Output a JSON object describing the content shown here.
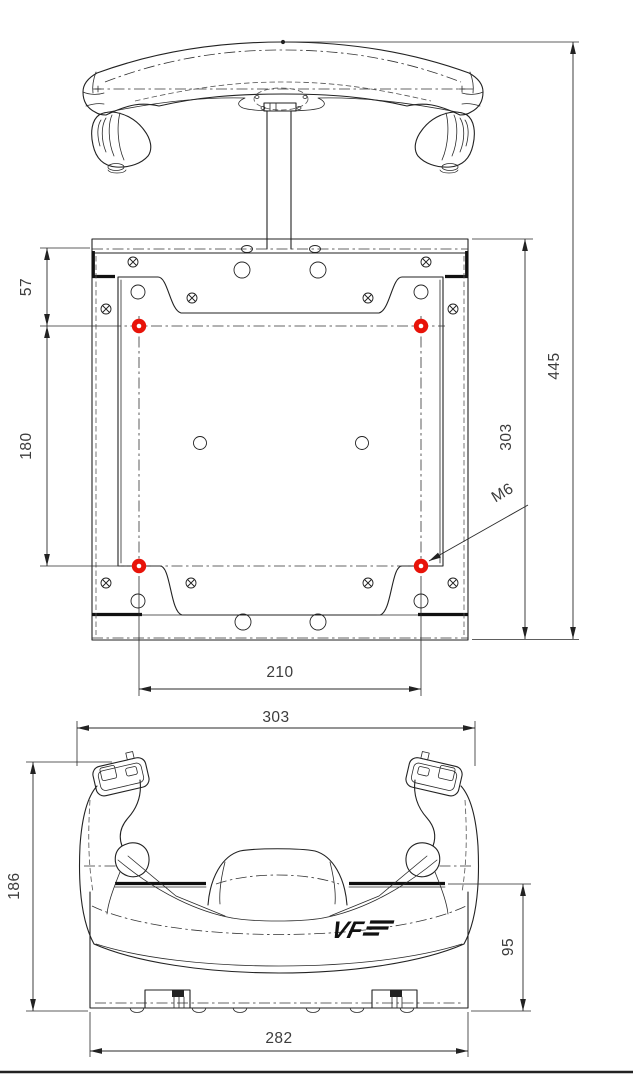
{
  "title": "Flight yoke mount – dimensioned technical drawing",
  "views": {
    "top": "yoke top view",
    "plate": "mounting plate top view",
    "front": "yoke front view"
  },
  "dimensions": {
    "overall_depth": "445",
    "plate_length": "303",
    "edge_to_first_hole": "57",
    "hole_pitch_vertical": "180",
    "hole_pitch_horizontal": "210",
    "thread_callout": "M6",
    "front_overall_width": "303",
    "front_overall_height": "186",
    "front_base_height": "95",
    "front_base_width": "282"
  },
  "logo_text": "VF",
  "colors": {
    "line": "#222222",
    "highlight_hole": "#e81309",
    "text": "#3c3c3c"
  }
}
